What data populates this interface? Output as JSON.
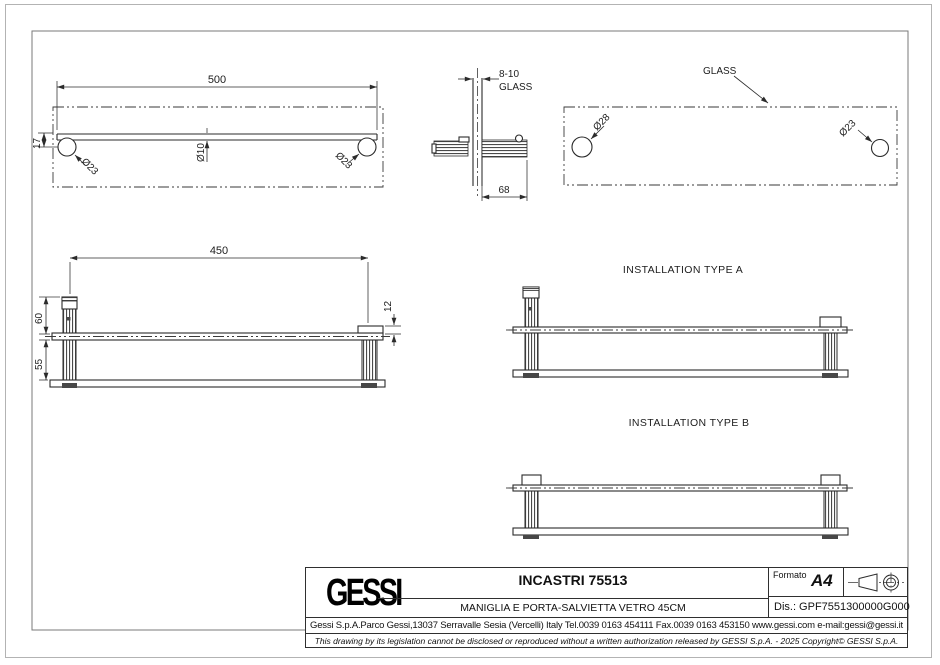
{
  "drawing": {
    "top_view": {
      "dim_width": "500",
      "dim_offset": "17",
      "dia_left": "Ø23",
      "dia_center": "Ø10",
      "dia_right": "Ø23"
    },
    "side_view": {
      "dim_thickness": "8-10",
      "glass_label": "GLASS",
      "dim_depth": "68"
    },
    "glass_view": {
      "glass_label": "GLASS",
      "dia_large": "Ø28",
      "dia_small": "Ø23"
    },
    "front_view": {
      "dim_centers": "450",
      "dim_upper": "60",
      "dim_lower": "55",
      "dim_cap": "12"
    },
    "installation_a": {
      "title": "INSTALLATION TYPE A"
    },
    "installation_b": {
      "title": "INSTALLATION TYPE B"
    }
  },
  "title_block": {
    "logo_text": "GESSI",
    "product_code": "INCASTRI 75513",
    "product_description": "MANIGLIA E PORTA-SALVIETTA VETRO 45CM",
    "format_label": "Formato",
    "format_value": "A4",
    "drawing_number": "Dis.: GPF7551300000G000",
    "company_line": "Gessi S.p.A.Parco Gessi,13037 Serravalle Sesia (Vercelli) Italy Tel.0039 0163 454111 Fax.0039 0163 453150 www.gessi.com e-mail:gessi@gessi.it",
    "legal_line": "This drawing by its legislation cannot be disclosed or reproduced without a written authorization released by GESSI S.p.A. - 2025 Copyright© GESSI S.p.A."
  },
  "colors": {
    "line": "#2b2b2b",
    "frame": "#7a7a7a",
    "paper_edge": "#b3b3b3"
  }
}
